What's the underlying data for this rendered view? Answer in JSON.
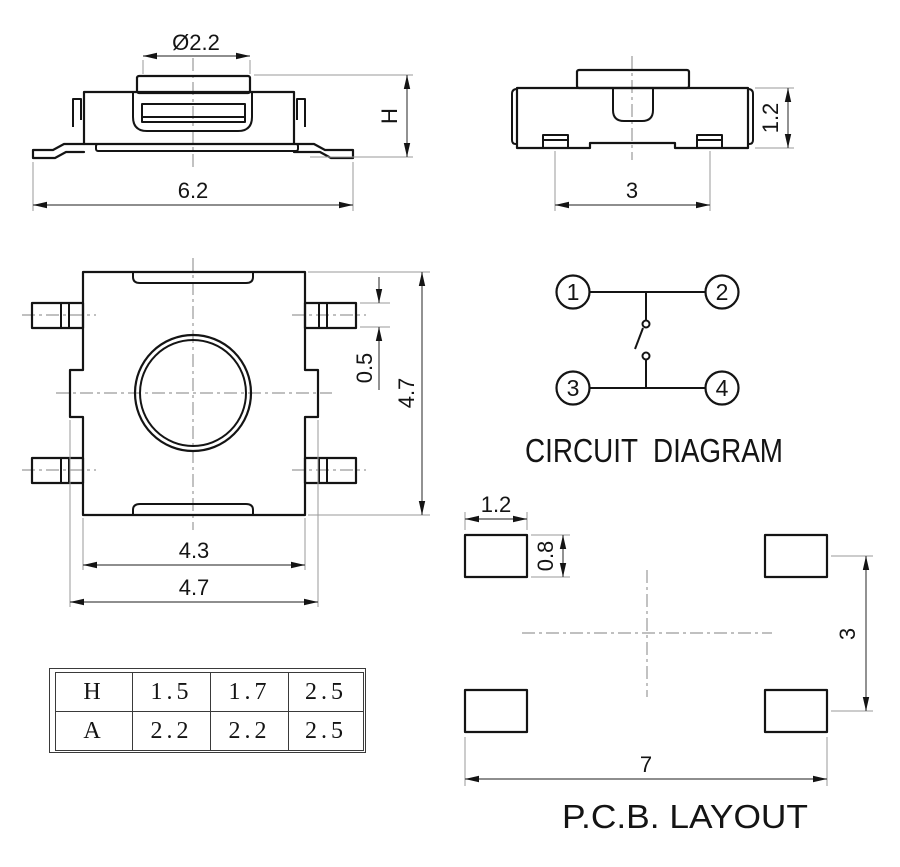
{
  "drawing": {
    "colors": {
      "ink": "#141414",
      "background": "#ffffff"
    },
    "front_view": {
      "dim_button_diameter": "Ø2.2",
      "dim_height": "H",
      "dim_overall_width": "6.2"
    },
    "side_view": {
      "dim_body_height": "1.2",
      "dim_foot_pitch": "3"
    },
    "top_view": {
      "dim_lead_width": "0.5",
      "dim_overall_height": "4.7",
      "dim_body_width": "4.3",
      "dim_overall_width": "4.7"
    },
    "circuit": {
      "title": "CIRCUIT  DIAGRAM",
      "terminal_1": "1",
      "terminal_2": "2",
      "terminal_3": "3",
      "terminal_4": "4"
    },
    "pcb": {
      "title": "P.C.B. LAYOUT",
      "dim_pad_width": "1.2",
      "dim_pad_height": "0.8",
      "dim_row_pitch": "3",
      "dim_pad_span": "7"
    },
    "table": {
      "rows": [
        {
          "label": "H",
          "values": [
            "1.5",
            "1.7",
            "2.5"
          ]
        },
        {
          "label": "A",
          "values": [
            "2.2",
            "2.2",
            "2.5"
          ]
        }
      ]
    }
  }
}
